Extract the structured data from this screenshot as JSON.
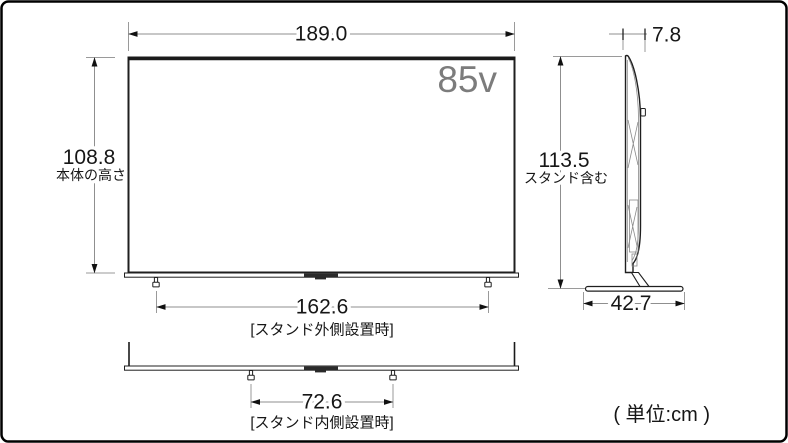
{
  "figure": {
    "unit_note": "( 単位:cm )",
    "front_view": {
      "screen_size_label": "85v",
      "width_cm": "189.0",
      "body_height_cm": "108.8",
      "body_height_caption": "本体の高さ",
      "stand_outer_width_cm": "162.6",
      "stand_outer_caption": "[スタンド外側設置時]",
      "stand_inner_width_cm": "72.6",
      "stand_inner_caption": "[スタンド内側設置時]"
    },
    "side_view": {
      "panel_depth_cm": "7.8",
      "total_height_cm": "113.5",
      "total_height_caption": "スタンド含む",
      "base_depth_cm": "42.7"
    }
  }
}
